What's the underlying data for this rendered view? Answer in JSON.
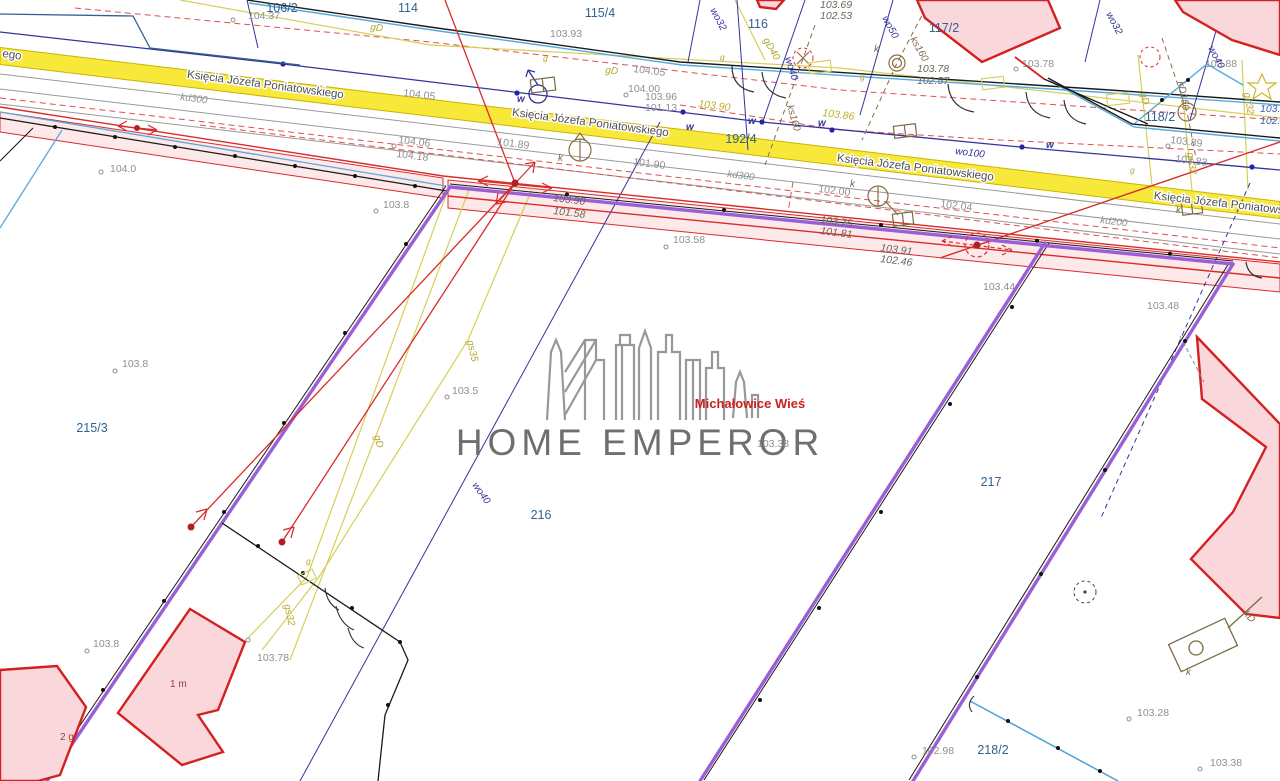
{
  "watermark": {
    "brand": "HOME EMPEROR",
    "location": "Michałowice Wieś"
  },
  "map": {
    "colors": {
      "road_fill": "#f7e83a",
      "road_edge": "#c9b400",
      "road_text": "#4f4f4f",
      "parcel_text": "#31618f",
      "elev_gray": "#8f8f8f",
      "elev_dark": "#6d665c",
      "elev_yellow": "#bfae2e",
      "elev_blue": "#3a5fae",
      "util_navy": "#34349b",
      "util_brown": "#7d6a4f",
      "util_olive": "#b8a52a",
      "boundary_purple": "#9a5fd6",
      "survey_red": "#d92b2b",
      "building_fill": "#f9d7da",
      "building_stroke": "#d42020",
      "building_label": "#9c3c3c",
      "pink_strip": "rgba(240,120,120,0.16)",
      "cyan_line": "#56aadd",
      "gray_line": "#9a9a9a",
      "black_line": "#1a1a1a"
    },
    "street": {
      "name": "Księcia Józefa Poniatowskiego",
      "fragment": "ego",
      "fragment_pos": {
        "x": 2,
        "y": 57,
        "r": 8
      },
      "instances": [
        {
          "x": 265,
          "y": 88,
          "r": 7.5
        },
        {
          "x": 590,
          "y": 126,
          "r": 7.5
        },
        {
          "x": 915,
          "y": 171,
          "r": 7
        },
        {
          "x": 1232,
          "y": 208,
          "r": 6.5
        }
      ]
    },
    "parcels": [
      {
        "id": "106/2",
        "x": 282,
        "y": 12
      },
      {
        "id": "114",
        "x": 408,
        "y": 12
      },
      {
        "id": "115/4",
        "x": 600,
        "y": 17
      },
      {
        "id": "116",
        "x": 758,
        "y": 28
      },
      {
        "id": "117/2",
        "x": 944,
        "y": 32
      },
      {
        "id": "118/2",
        "x": 1160,
        "y": 121
      },
      {
        "id": "192/4",
        "x": 741,
        "y": 143
      },
      {
        "id": "215/3",
        "x": 92,
        "y": 432
      },
      {
        "id": "216",
        "x": 541,
        "y": 519
      },
      {
        "id": "217",
        "x": 991,
        "y": 486
      },
      {
        "id": "218/2",
        "x": 993,
        "y": 754
      }
    ],
    "elevations": [
      {
        "v": "104.37",
        "s": "elev",
        "x": 248,
        "y": 19
      },
      {
        "v": "104.0",
        "s": "elev",
        "x": 110,
        "y": 172
      },
      {
        "v": "104.05",
        "s": "elev",
        "x": 403,
        "y": 96,
        "r": 7
      },
      {
        "v": "104.06",
        "s": "elev",
        "x": 398,
        "y": 143,
        "r": 7
      },
      {
        "v": "104.18",
        "s": "elev",
        "x": 396,
        "y": 157,
        "r": 7
      },
      {
        "v": "103.93",
        "s": "elev",
        "x": 550,
        "y": 37
      },
      {
        "v": "104.05",
        "s": "elev",
        "x": 633,
        "y": 72,
        "r": 7
      },
      {
        "v": "104.00",
        "s": "elev",
        "x": 628,
        "y": 92
      },
      {
        "v": "103.96",
        "s": "elev",
        "x": 645,
        "y": 100
      },
      {
        "v": "101.13",
        "s": "elev",
        "x": 645,
        "y": 111
      },
      {
        "v": "101.89",
        "s": "elev",
        "x": 497,
        "y": 145,
        "r": 7
      },
      {
        "v": "101.90",
        "s": "elev",
        "x": 633,
        "y": 165,
        "r": 7
      },
      {
        "v": "102.00",
        "s": "elev",
        "x": 818,
        "y": 192,
        "r": 7
      },
      {
        "v": "102.04",
        "s": "elev",
        "x": 940,
        "y": 207,
        "r": 7
      },
      {
        "v": "103.58",
        "s": "elev",
        "x": 673,
        "y": 243
      },
      {
        "v": "103.8",
        "s": "elev",
        "x": 383,
        "y": 208
      },
      {
        "v": "103.8",
        "s": "elev",
        "x": 122,
        "y": 367
      },
      {
        "v": "103.5",
        "s": "elev",
        "x": 452,
        "y": 394
      },
      {
        "v": "103.38",
        "s": "elev",
        "x": 757,
        "y": 447
      },
      {
        "v": "103.8",
        "s": "elev",
        "x": 93,
        "y": 647
      },
      {
        "v": "103.78",
        "s": "elev",
        "x": 257,
        "y": 661
      },
      {
        "v": "103.44",
        "s": "elev",
        "x": 983,
        "y": 290
      },
      {
        "v": "103.48",
        "s": "elev",
        "x": 1147,
        "y": 309
      },
      {
        "v": "103.78",
        "s": "elev",
        "x": 1022,
        "y": 67
      },
      {
        "v": "103.88",
        "s": "elev",
        "x": 1205,
        "y": 67
      },
      {
        "v": "103.89",
        "s": "elev",
        "x": 1170,
        "y": 143,
        "r": 7
      },
      {
        "v": "103.83",
        "s": "elev",
        "x": 1175,
        "y": 162,
        "r": 7
      },
      {
        "v": "102.98",
        "s": "elev",
        "x": 922,
        "y": 754
      },
      {
        "v": "103.28",
        "s": "elev",
        "x": 1137,
        "y": 716
      },
      {
        "v": "103.38",
        "s": "elev",
        "x": 1210,
        "y": 766
      },
      {
        "v": "103.69",
        "s": "ed",
        "x": 820,
        "y": 8
      },
      {
        "v": "102.53",
        "s": "ed",
        "x": 820,
        "y": 19
      },
      {
        "v": "103.78",
        "s": "ed",
        "x": 917,
        "y": 72
      },
      {
        "v": "102.57",
        "s": "ed",
        "x": 917,
        "y": 84
      },
      {
        "v": "103.90",
        "s": "ed",
        "x": 553,
        "y": 201,
        "r": 7
      },
      {
        "v": "101.58",
        "s": "ed",
        "x": 553,
        "y": 214,
        "r": 7
      },
      {
        "v": "103.75",
        "s": "ed",
        "x": 820,
        "y": 223,
        "r": 7
      },
      {
        "v": "101.81",
        "s": "ed",
        "x": 820,
        "y": 234,
        "r": 7
      },
      {
        "v": "103.91",
        "s": "ed",
        "x": 880,
        "y": 251,
        "r": 7
      },
      {
        "v": "102.46",
        "s": "ed",
        "x": 880,
        "y": 262,
        "r": 7
      },
      {
        "v": "103.90",
        "s": "ey",
        "x": 698,
        "y": 107,
        "r": 7
      },
      {
        "v": "103.86",
        "s": "ey",
        "x": 822,
        "y": 116,
        "r": 7
      },
      {
        "v": "103.9",
        "s": "eb",
        "x": 1260,
        "y": 112
      },
      {
        "v": "102.1",
        "s": "eb",
        "x": 1260,
        "y": 124
      }
    ],
    "utilities": [
      {
        "code": "kd300",
        "s": "ug",
        "x": 180,
        "y": 100,
        "r": 7
      },
      {
        "code": "kd300",
        "s": "ug",
        "x": 727,
        "y": 177,
        "r": 7
      },
      {
        "code": "kd200",
        "s": "ug",
        "x": 1100,
        "y": 223,
        "r": 7
      },
      {
        "code": "wo100",
        "s": "un",
        "x": 955,
        "y": 154,
        "r": 7
      },
      {
        "code": "wo40",
        "s": "un",
        "x": 785,
        "y": 58,
        "r": 73
      },
      {
        "code": "wo40",
        "s": "un",
        "x": 1208,
        "y": 48,
        "r": 62
      },
      {
        "code": "wo50",
        "s": "un",
        "x": 882,
        "y": 18,
        "r": 62
      },
      {
        "code": "wo32",
        "s": "un",
        "x": 710,
        "y": 10,
        "r": 62
      },
      {
        "code": "wo32",
        "s": "un",
        "x": 1106,
        "y": 14,
        "r": 62
      },
      {
        "code": "wo40",
        "s": "un",
        "x": 472,
        "y": 485,
        "r": 55
      },
      {
        "code": "ks160",
        "s": "ub",
        "x": 787,
        "y": 106,
        "r": 74
      },
      {
        "code": "ks160",
        "s": "ub",
        "x": 910,
        "y": 39,
        "r": 60
      },
      {
        "code": "kD150",
        "s": "ub",
        "x": 1178,
        "y": 82,
        "r": 80
      },
      {
        "code": "kD",
        "s": "ub",
        "x": 1243,
        "y": 614,
        "r": 48
      },
      {
        "code": "gD40",
        "s": "uo",
        "x": 763,
        "y": 40,
        "r": 60
      },
      {
        "code": "gD",
        "s": "uo",
        "x": 605,
        "y": 73,
        "r": 7
      },
      {
        "code": "gD",
        "s": "uo",
        "x": 370,
        "y": 30,
        "r": 7
      },
      {
        "code": "gD",
        "s": "uo",
        "x": 1140,
        "y": 93,
        "r": 75
      },
      {
        "code": "gD",
        "s": "uo",
        "x": 374,
        "y": 436,
        "r": 75
      },
      {
        "code": "gn32",
        "s": "uo",
        "x": 1187,
        "y": 153,
        "r": 80
      },
      {
        "code": "gn32",
        "s": "uo",
        "x": 1244,
        "y": 93,
        "r": 80
      },
      {
        "code": "gs35",
        "s": "uo",
        "x": 467,
        "y": 341,
        "r": 77
      },
      {
        "code": "gs32",
        "s": "uo",
        "x": 284,
        "y": 605,
        "r": 77
      }
    ],
    "letters": [
      {
        "ch": "w",
        "s": "lw",
        "x": 517,
        "y": 102
      },
      {
        "ch": "w",
        "s": "lw",
        "x": 686,
        "y": 130
      },
      {
        "ch": "w",
        "s": "lw",
        "x": 748,
        "y": 124
      },
      {
        "ch": "w",
        "s": "lw",
        "x": 818,
        "y": 126
      },
      {
        "ch": "w",
        "s": "lw",
        "x": 1046,
        "y": 148
      },
      {
        "ch": "g",
        "s": "lg",
        "x": 543,
        "y": 61
      },
      {
        "ch": "g",
        "s": "lg",
        "x": 720,
        "y": 60
      },
      {
        "ch": "g",
        "s": "lg",
        "x": 860,
        "y": 80
      },
      {
        "ch": "g",
        "s": "lg",
        "x": 1130,
        "y": 173
      },
      {
        "ch": "g",
        "s": "lg",
        "x": 306,
        "y": 564
      },
      {
        "ch": "k",
        "s": "lk",
        "x": 558,
        "y": 161
      },
      {
        "ch": "k",
        "s": "lk",
        "x": 850,
        "y": 187
      },
      {
        "ch": "k",
        "s": "lk",
        "x": 874,
        "y": 52
      },
      {
        "ch": "k",
        "s": "lk",
        "x": 1176,
        "y": 213
      },
      {
        "ch": "k",
        "s": "lk",
        "x": 1186,
        "y": 675
      }
    ],
    "building_labels": [
      {
        "t": "1 m",
        "x": 170,
        "y": 687
      },
      {
        "t": "2 g",
        "x": 60,
        "y": 740
      }
    ],
    "point_markers": [
      {
        "x": 233,
        "y": 20
      },
      {
        "x": 101,
        "y": 172
      },
      {
        "x": 626,
        "y": 95
      },
      {
        "x": 666,
        "y": 247
      },
      {
        "x": 376,
        "y": 211
      },
      {
        "x": 115,
        "y": 371
      },
      {
        "x": 447,
        "y": 397
      },
      {
        "x": 87,
        "y": 651
      },
      {
        "x": 1016,
        "y": 69
      },
      {
        "x": 914,
        "y": 757
      },
      {
        "x": 1129,
        "y": 719
      },
      {
        "x": 1200,
        "y": 769
      },
      {
        "x": 248,
        "y": 640
      },
      {
        "x": 1168,
        "y": 146
      },
      {
        "x": 394,
        "y": 146
      }
    ]
  }
}
